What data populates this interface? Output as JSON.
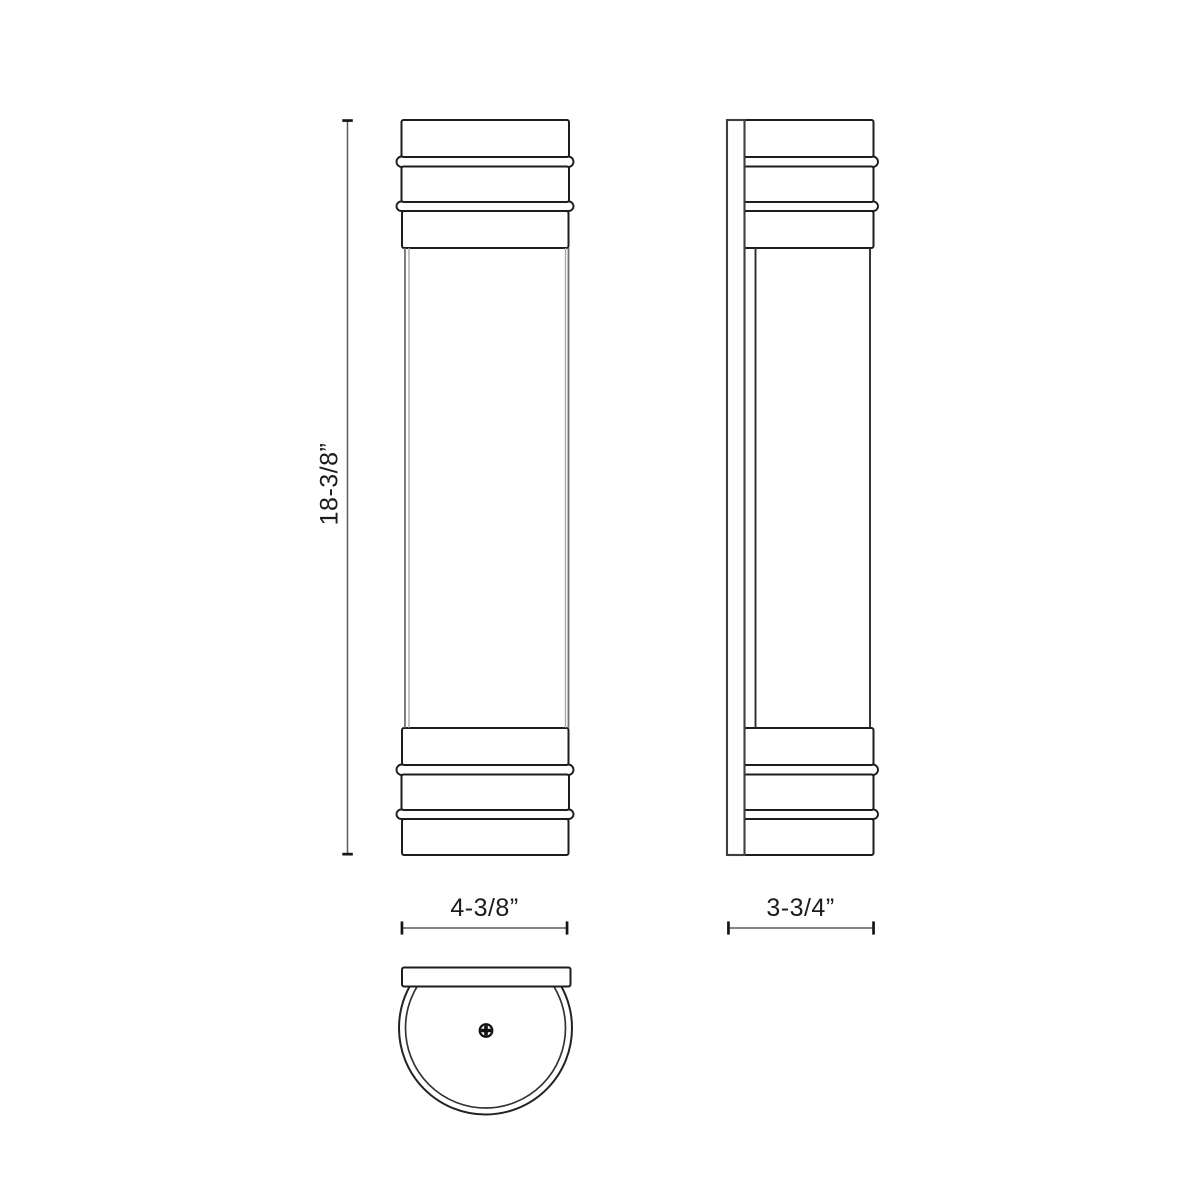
{
  "canvas": {
    "background": "#ffffff",
    "line_color": "#1d1d1d",
    "dimension_line_color": "#5a5a5a",
    "text_color": "#1c1c1c"
  },
  "dimensions": {
    "height": {
      "label": "18-3/8”"
    },
    "width": {
      "label": "4-3/8”"
    },
    "depth": {
      "label": "3-3/4”"
    }
  },
  "icons": {
    "screw": "phillips-screw-icon"
  }
}
